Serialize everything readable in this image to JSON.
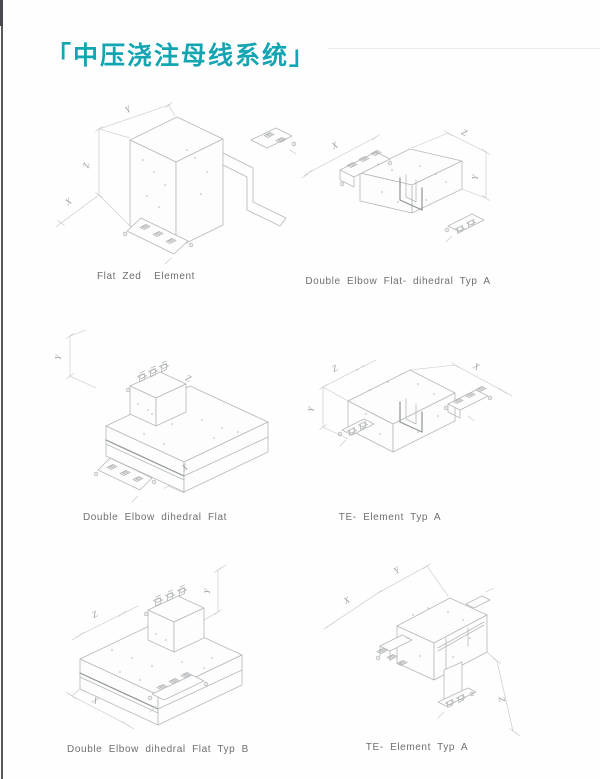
{
  "page": {
    "title": "「中压浇注母线系统」"
  },
  "colors": {
    "accent_teal": "#14a5b3",
    "caption_gray": "#6f6f6f",
    "drawing_line_gray": "#b5b8ba",
    "scan_edge_gray": "#58585c"
  },
  "figures": [
    {
      "name": "Flat Zed Element",
      "caption": "Flat Zed  Element",
      "dims": {
        "d1": "Y",
        "d2": "Z",
        "d3": "X"
      }
    },
    {
      "name": "Double Elbow Flat- dihedral Typ A",
      "caption": "Double Elbow Flat- dihedral Typ A",
      "dims": {
        "d1": "X",
        "d2": "Z",
        "d3": "Y"
      }
    },
    {
      "name": "Double Elbow dihedral Flat",
      "caption": "Double Elbow dihedral Flat",
      "dims": {
        "d1": "Y",
        "d2": "Z",
        "d3": "X"
      }
    },
    {
      "name": "TE- Element Typ A",
      "caption": "TE- Element Typ A",
      "dims": {
        "d1": "Z",
        "d2": "Y",
        "d3": "X"
      }
    },
    {
      "name": "Double Elbow dihedral Flat Typ B",
      "caption": "Double Elbow dihedral Flat Typ B",
      "dims": {
        "d1": "Z",
        "d2": "Y",
        "d3": "X"
      }
    },
    {
      "name": "TE- Element Typ A",
      "caption": "TE- Element Typ A",
      "dims": {
        "d1": "X",
        "d2": "Y",
        "d3": "Z"
      }
    }
  ]
}
